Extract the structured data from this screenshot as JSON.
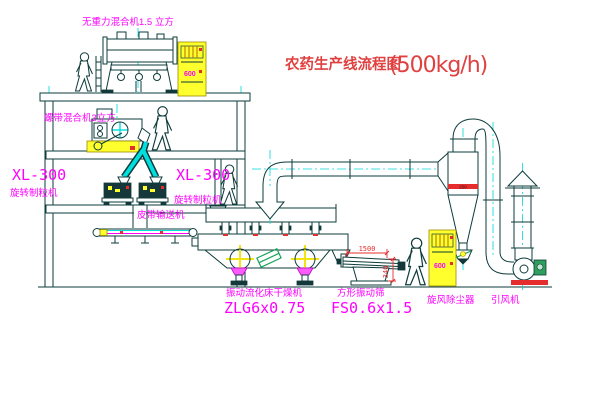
{
  "title": {
    "name": "农药生产线流程图",
    "capacity": "(500kg/h)"
  },
  "equipment_labels": {
    "gravity_mixer": "无重力混合机1.5 立方",
    "ribbon_mixer": "螺带混合机3立方",
    "granulator_left": {
      "model": "XL-300",
      "name": "旋转制粒机"
    },
    "granulator_right": {
      "model": "XL-300",
      "name": "旋转制粒机"
    },
    "belt_conveyor": "皮带输送机",
    "fluid_bed_dryer": {
      "name": "振动流化床干燥机",
      "model": "ZLG6x0.75"
    },
    "vibrating_screen": {
      "name": "方形振动筛",
      "model": "FS0.6x1.5"
    },
    "cyclone": "旋风除尘器",
    "fan": "引风机"
  },
  "dimensions": {
    "screen_length": "1500",
    "screen_height": "340",
    "cyclone_band": "250"
  },
  "control_cabinet": {
    "panel_text": "600"
  },
  "colors": {
    "line": "#0e3b3b",
    "centerline_cyan": "#00d8d8",
    "label_magenta": "#ff00ff",
    "title_red": "#e04040",
    "cabinet_yellow": "#ffff2e",
    "mark_red": "#e62d2d",
    "mark_green": "#17a35a",
    "background": "#ffffff"
  }
}
